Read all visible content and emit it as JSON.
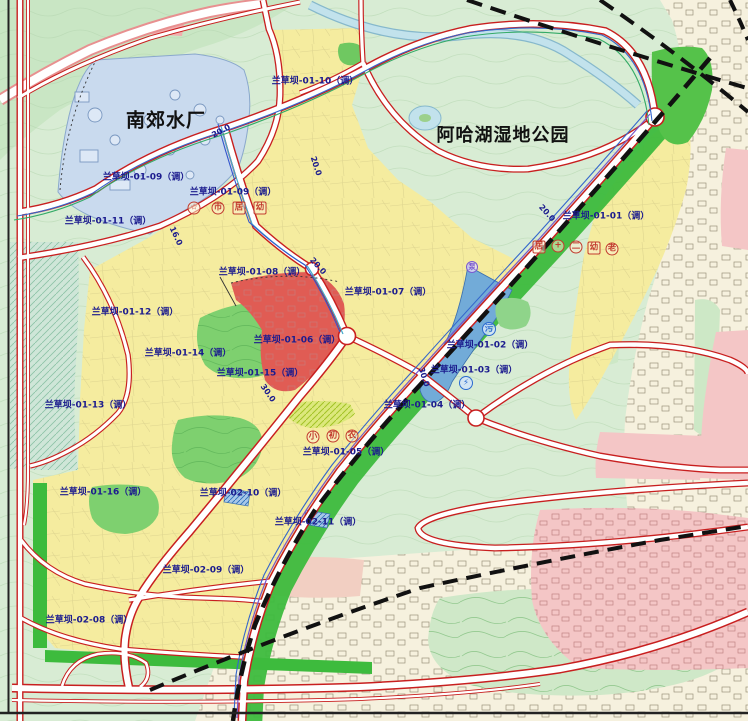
{
  "map": {
    "titles": [
      {
        "id": "water-plant-title",
        "text": "南郊水厂",
        "x": 166,
        "y": 119,
        "size": 19
      },
      {
        "id": "wetland-park-title",
        "text": "阿哈湖湿地公园",
        "x": 503,
        "y": 134,
        "size": 18
      }
    ],
    "parcel_labels": [
      {
        "text": "兰草坝-01-10（调）",
        "x": 315,
        "y": 80
      },
      {
        "text": "兰草坝-01-09（调）",
        "x": 146,
        "y": 176
      },
      {
        "text": "兰草坝-01-09（调）",
        "x": 233,
        "y": 191
      },
      {
        "text": "兰草坝-01-11（调）",
        "x": 108,
        "y": 220
      },
      {
        "text": "兰草坝-01-01（调）",
        "x": 606,
        "y": 215
      },
      {
        "text": "兰草坝-01-08（调）",
        "x": 262,
        "y": 271
      },
      {
        "text": "兰草坝-01-07（调）",
        "x": 388,
        "y": 291
      },
      {
        "text": "兰草坝-01-12（调）",
        "x": 135,
        "y": 311
      },
      {
        "text": "兰草坝-01-06（调）",
        "x": 297,
        "y": 339
      },
      {
        "text": "兰草坝-01-02（调）",
        "x": 490,
        "y": 344
      },
      {
        "text": "兰草坝-01-14（调）",
        "x": 188,
        "y": 352
      },
      {
        "text": "兰草坝-01-03（调）",
        "x": 474,
        "y": 369
      },
      {
        "text": "兰草坝-01-15（调）",
        "x": 260,
        "y": 372
      },
      {
        "text": "兰草坝-01-13（调）",
        "x": 88,
        "y": 404
      },
      {
        "text": "兰草坝-01-04（调）",
        "x": 427,
        "y": 404
      },
      {
        "text": "兰草坝-01-05（调）",
        "x": 346,
        "y": 451
      },
      {
        "text": "兰草坝-01-16（调）",
        "x": 103,
        "y": 491
      },
      {
        "text": "兰草坝-02-10（调）",
        "x": 243,
        "y": 492
      },
      {
        "text": "兰草坝-02-11（调）",
        "x": 318,
        "y": 521
      },
      {
        "text": "兰草坝-02-09（调）",
        "x": 206,
        "y": 569
      },
      {
        "text": "兰草坝-02-08（调）",
        "x": 89,
        "y": 619
      }
    ],
    "road_width_labels": [
      {
        "text": "20.0",
        "x": 221,
        "y": 131,
        "rot": -28
      },
      {
        "text": "20.0",
        "x": 316,
        "y": 166,
        "rot": 72
      },
      {
        "text": "16.0",
        "x": 176,
        "y": 236,
        "rot": 65
      },
      {
        "text": "20.0",
        "x": 318,
        "y": 266,
        "rot": 48
      },
      {
        "text": "20.0",
        "x": 547,
        "y": 213,
        "rot": 48
      },
      {
        "text": "30.0",
        "x": 268,
        "y": 393,
        "rot": 55
      },
      {
        "text": "30.0",
        "x": 424,
        "y": 377,
        "rot": 72
      }
    ],
    "facility_icons": [
      {
        "name": "star-icon",
        "glyph": "☆",
        "shape": "circle",
        "style": "red",
        "x": 194,
        "y": 208
      },
      {
        "name": "market-icon",
        "glyph": "市",
        "shape": "circle",
        "style": "red",
        "x": 218,
        "y": 208
      },
      {
        "name": "community-center-icon",
        "glyph": "居",
        "shape": "square",
        "style": "red",
        "x": 239,
        "y": 208
      },
      {
        "name": "kindergarten-icon",
        "glyph": "幼",
        "shape": "square",
        "style": "red",
        "x": 260,
        "y": 208
      },
      {
        "name": "community-center-icon",
        "glyph": "居",
        "shape": "square",
        "style": "red",
        "x": 539,
        "y": 247
      },
      {
        "name": "hospital-icon",
        "glyph": "+",
        "shape": "circle",
        "style": "red",
        "x": 558,
        "y": 246
      },
      {
        "name": "school-no2-icon",
        "glyph": "二",
        "shape": "circle",
        "style": "red",
        "x": 576,
        "y": 247
      },
      {
        "name": "kindergarten-icon",
        "glyph": "幼",
        "shape": "square",
        "style": "red",
        "x": 594,
        "y": 248
      },
      {
        "name": "elderly-care-icon",
        "glyph": "老",
        "shape": "circle",
        "style": "red",
        "x": 612,
        "y": 249
      },
      {
        "name": "primary-school-icon",
        "glyph": "小",
        "shape": "circle",
        "style": "red",
        "x": 313,
        "y": 437
      },
      {
        "name": "junior-high-icon",
        "glyph": "初",
        "shape": "circle",
        "style": "red",
        "x": 333,
        "y": 436
      },
      {
        "name": "farmers-market-icon",
        "glyph": "农",
        "shape": "circle",
        "style": "red",
        "x": 352,
        "y": 436
      },
      {
        "name": "sewage-plant-icon",
        "glyph": "污",
        "shape": "circle",
        "style": "blue",
        "x": 489,
        "y": 329
      },
      {
        "name": "substation-icon",
        "glyph": "⚡",
        "shape": "circle",
        "style": "blue",
        "x": 466,
        "y": 383
      },
      {
        "name": "pump-station-icon",
        "glyph": "泵",
        "shape": "circle",
        "style": "purple",
        "x": 472,
        "y": 267
      }
    ],
    "colors": {
      "parcel_label": "#1b1b8e",
      "title": "#111111",
      "road_red": "#c81f1f",
      "residential_yellow": "#f5ec9f",
      "park_green": "#7ed06f",
      "greenbelt": "#3dbb3d",
      "utility_blue": "#72abd8",
      "commercial_red": "#e05c54",
      "existing_pink": "#f4c6c6",
      "water_blue": "#c2e2ec",
      "plant_bluegray": "#c9daee"
    }
  }
}
